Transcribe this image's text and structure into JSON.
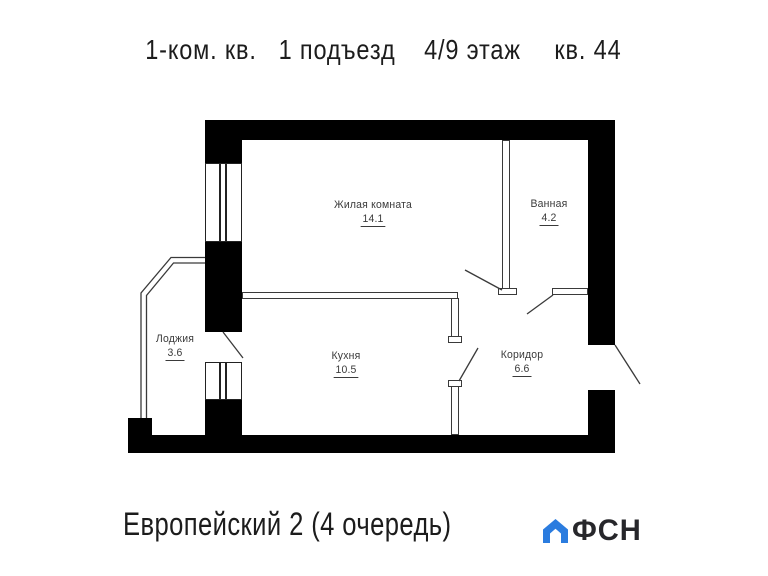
{
  "header": {
    "title_parts": [
      "1-ком. кв.",
      "1 подъезд",
      "4/9 этаж",
      "кв. 44"
    ]
  },
  "rooms": [
    {
      "name": "Жилая комната",
      "area": "14.1"
    },
    {
      "name": "Ванная",
      "area": "4.2"
    },
    {
      "name": "Лоджия",
      "area": "3.6"
    },
    {
      "name": "Кухня",
      "area": "10.5"
    },
    {
      "name": "Коридор",
      "area": "6.6"
    }
  ],
  "footer": {
    "project": "Европейский 2 (4 очередь)",
    "brand": "ФСН"
  },
  "icons": {
    "brand_house": "house-icon"
  },
  "colors": {
    "wall": "#000000",
    "line": "#3a3a3a",
    "text": "#1c1c1c",
    "brand-blue": "#2b7cdf"
  }
}
